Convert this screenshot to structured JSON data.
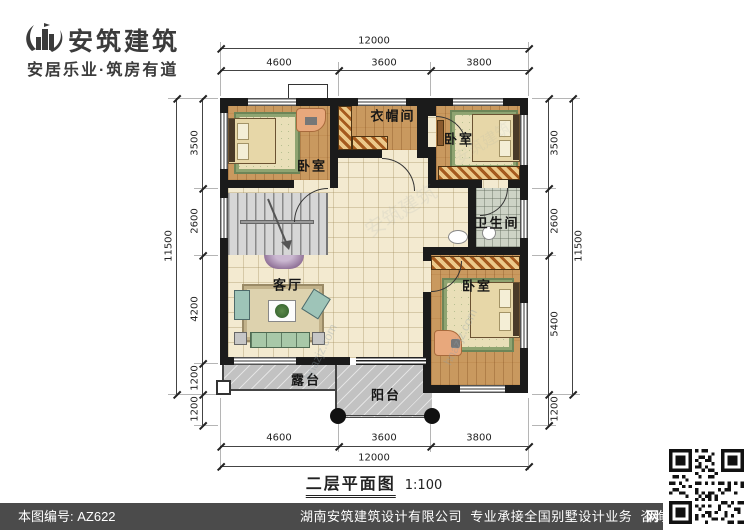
{
  "logo": {
    "title": "安筑建筑",
    "tagline": "安居乐业·筑房有道"
  },
  "floorplan": {
    "caption": "二层平面图",
    "scale_label": "1:100",
    "rooms": {
      "bedroom_tl": "卧室",
      "cloakroom": "衣帽间",
      "bedroom_tr": "卧室",
      "bathroom": "卫生间",
      "bedroom_br": "卧室",
      "living": "客厅",
      "terrace": "露台",
      "balcony": "阳台"
    },
    "dims": {
      "top_total": "12000",
      "top_segs": [
        "4600",
        "3600",
        "3800"
      ],
      "bottom_total": "12000",
      "bottom_segs": [
        "4600",
        "3600",
        "3800"
      ],
      "left_total": "11500",
      "left_segs": [
        "3500",
        "2600",
        "4200",
        "1200"
      ],
      "left_extra": "1200",
      "right_total": "11500",
      "right_segs": [
        "3500",
        "2600",
        "5400"
      ],
      "right_extra": "1200"
    }
  },
  "watermarks": {
    "brand": "安筑建筑",
    "site": "hnazjz.com"
  },
  "footer": {
    "drawing_no": "本图编号: AZ622",
    "company": "湖南安筑建筑设计有限公司",
    "service": "专业承接全国别墅设计业务",
    "phone": "咨询电话: 400-8070-511",
    "net": "网"
  },
  "colors": {
    "wall": "#1b1b1b",
    "wood": "#c9995f",
    "tile": "#f3ead0",
    "footer_bg": "#4b4b4b",
    "accent_hatch": "#a55a1e"
  }
}
